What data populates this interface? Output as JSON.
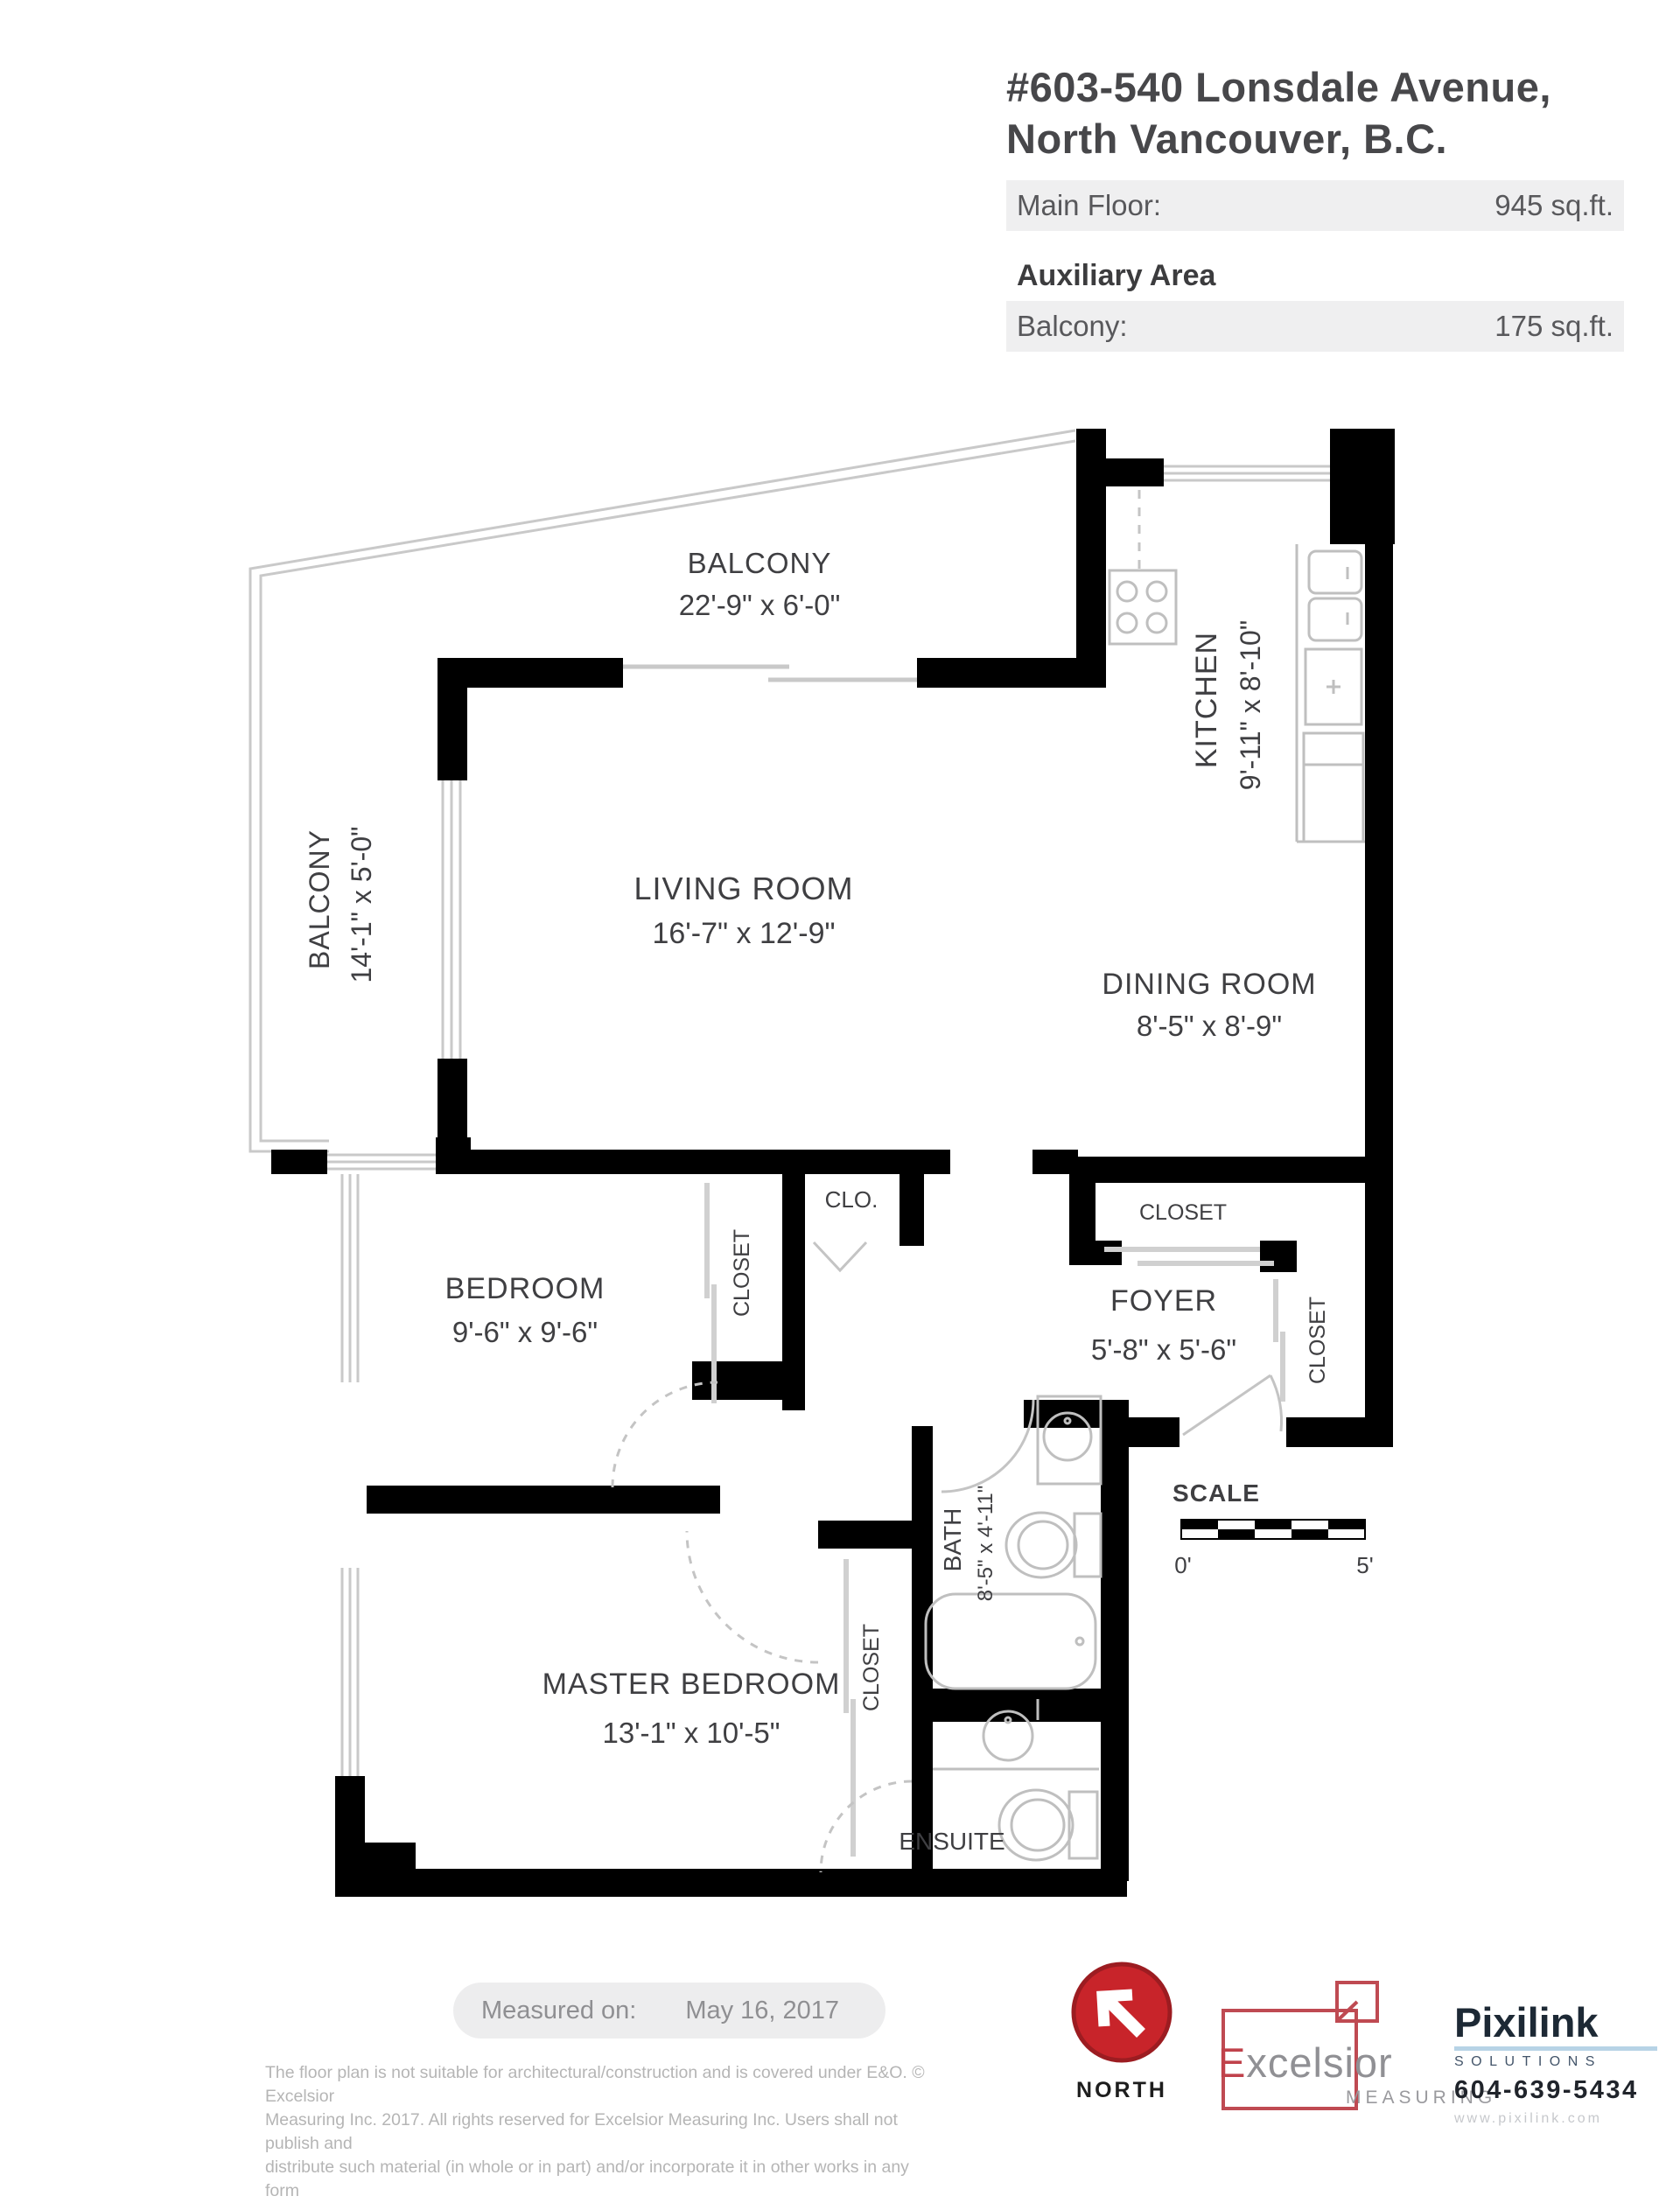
{
  "header": {
    "address_line1": "#603-540 Lonsdale Avenue,",
    "address_line2": "North Vancouver, B.C.",
    "main_floor_label": "Main Floor:",
    "main_floor_value": "945 sq.ft.",
    "auxiliary_label": "Auxiliary Area",
    "balcony_label": "Balcony:",
    "balcony_value": "175 sq.ft."
  },
  "floorplan": {
    "rooms": {
      "balcony_top": {
        "name": "BALCONY",
        "dims": "22'-9\" x 6'-0\""
      },
      "balcony_left": {
        "name": "BALCONY",
        "dims": "14'-1\" x 5'-0\""
      },
      "living": {
        "name": "LIVING ROOM",
        "dims": "16'-7\" x 12'-9\""
      },
      "kitchen": {
        "name": "KITCHEN",
        "dims": "9'-11\" x 8'-10\""
      },
      "dining": {
        "name": "DINING ROOM",
        "dims": "8'-5\" x 8'-9\""
      },
      "bedroom": {
        "name": "BEDROOM",
        "dims": "9'-6\" x 9'-6\""
      },
      "master": {
        "name": "MASTER BEDROOM",
        "dims": "13'-1\" x 10'-5\""
      },
      "foyer": {
        "name": "FOYER",
        "dims": "5'-8\" x 5'-6\""
      },
      "bath": {
        "name": "BATH",
        "dims": "8'-5\" x 4'-11\""
      },
      "ensuite": {
        "name": "ENSUITE"
      },
      "clo": {
        "name": "CLO."
      },
      "closet_bedroom": {
        "name": "CLOSET"
      },
      "closet_master": {
        "name": "CLOSET"
      },
      "closet_foyer_top": {
        "name": "CLOSET"
      },
      "closet_foyer_right": {
        "name": "CLOSET"
      }
    },
    "scale": {
      "label": "SCALE",
      "start": "0'",
      "end": "5'"
    }
  },
  "footer": {
    "measured_on_label": "Measured on:",
    "measured_on_date": "May 16, 2017",
    "disclaimer_line1": "The floor plan is not suitable for architectural/construction and is covered under E&O. © Excelsior",
    "disclaimer_line2": "Measuring Inc. 2017. All rights reserved for Excelsior Measuring Inc. Users shall not publish and",
    "disclaimer_line3": "distribute such material (in whole or in part) and/or incorporate it in other works in any form",
    "north_label": "NORTH",
    "excelsior": {
      "initial": "E",
      "rest": "xcelsior",
      "sub": "MEASURING"
    },
    "pixilink": {
      "name": "Pixilink",
      "sub": "SOLUTIONS",
      "phone": "604-639-5434",
      "web": "www.pixilink.com"
    }
  },
  "colors": {
    "wall": "#000000",
    "thin_line": "#c9c9c9",
    "fixture_line": "#bfbfbf",
    "label_text": "#3f3f42",
    "bar_background": "#efeff0",
    "bar_text": "#58585b",
    "north_red": "#c8242a",
    "excelsior_red": "#bf4a52",
    "pixilink_navy": "#1d2935",
    "pixilink_blue": "#b7d3e6",
    "muted_text": "#8f8f92",
    "faint_text": "#b5b5b5"
  }
}
